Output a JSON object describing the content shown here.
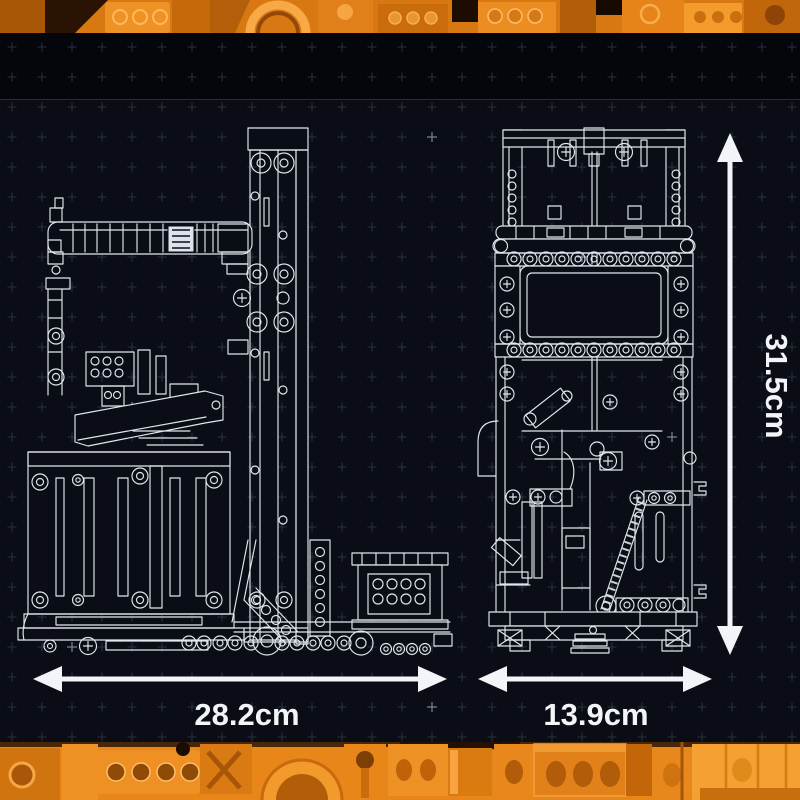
{
  "dimensions": {
    "width_label": "28.2cm",
    "depth_label": "13.9cm",
    "height_label": "31.5cm"
  },
  "icons": {
    "width_arrow": "horizontal-double-headed-arrow",
    "depth_arrow": "horizontal-double-headed-arrow",
    "height_arrow": "vertical-double-headed-arrow"
  },
  "colors": {
    "brick_band_orange": "#e8861a",
    "brick_band_highlight": "#f7a843",
    "brick_band_shadow": "#8f4a06",
    "blueprint_background": "#0a0d15",
    "header_mask_black": "#04060b",
    "wireframe_line": "#e2e7ed",
    "grid_cross": "#454c5c",
    "dimension_white": "#f2f5f7"
  }
}
